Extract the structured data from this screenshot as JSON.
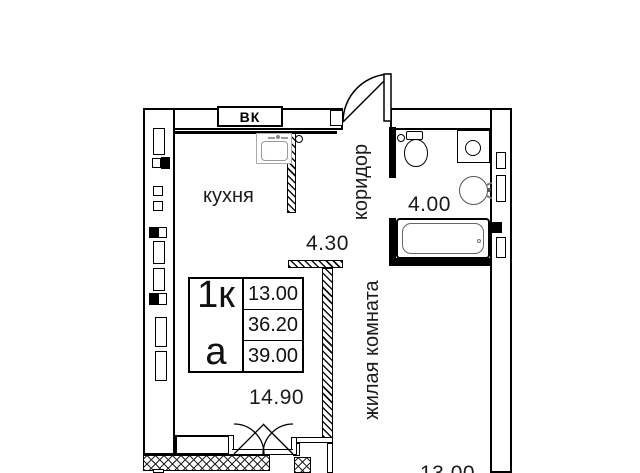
{
  "info_box": {
    "rooms_label": "1к",
    "letter": "а",
    "areas": [
      "13.00",
      "36.20",
      "39.00"
    ]
  },
  "room_labels": {
    "kitchen": "кухня",
    "corridor": "коридор",
    "living_room": "жилая комната"
  },
  "area_labels": {
    "kitchen": "14.90",
    "corridor": "4.30",
    "bathroom": "4.00",
    "living_room": "13.00"
  },
  "wall_labels": {
    "vent_shaft": "ВК"
  },
  "colors": {
    "line": "#000000",
    "background": "#ffffff"
  }
}
